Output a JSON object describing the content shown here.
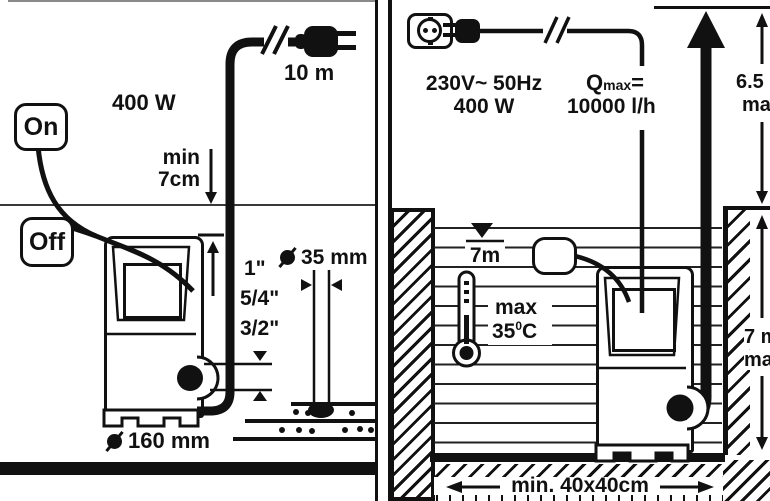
{
  "panel_left": {
    "power_label": "400 W",
    "cable_length_label": "10 m",
    "switch_on_label": "On",
    "switch_off_label": "Off",
    "min_depth_line1": "min",
    "min_depth_line2": "7cm",
    "thread_sizes": [
      "1\"",
      "5/4\"",
      "3/2\""
    ],
    "hose_diameter_label": "35 mm",
    "pump_diameter_label": "160 mm"
  },
  "panel_right": {
    "voltage_label": "230V~ 50Hz",
    "power_label": "400 W",
    "qmax_prefix": "Q",
    "qmax_sub": "max",
    "qmax_eq": "=",
    "qmax_value": "10000 l/h",
    "head_height_value": "6.5 m",
    "head_height_max": "max",
    "immersion_value": "7 m",
    "immersion_max": "max",
    "water_level_label": "7m",
    "temp_label": "max",
    "temp_value": "35",
    "temp_degree": "0",
    "temp_unit": "C",
    "pit_size_label": "min. 40x40cm"
  },
  "icons": {
    "plug-icon": "black mains plug silhouette",
    "socket-icon": "schuko wall socket outline",
    "cable-break-icon": "double slash cable interruption",
    "water-level-icon": "filled triangle over line",
    "thermometer-icon": "thermometer with bulb",
    "float-switch-icon": "rounded float body",
    "diameter-icon": "filled circle with slash",
    "flow-arrow-icon": "thick upward arrow"
  },
  "colors": {
    "ink": "#111111",
    "background": "#ffffff"
  }
}
